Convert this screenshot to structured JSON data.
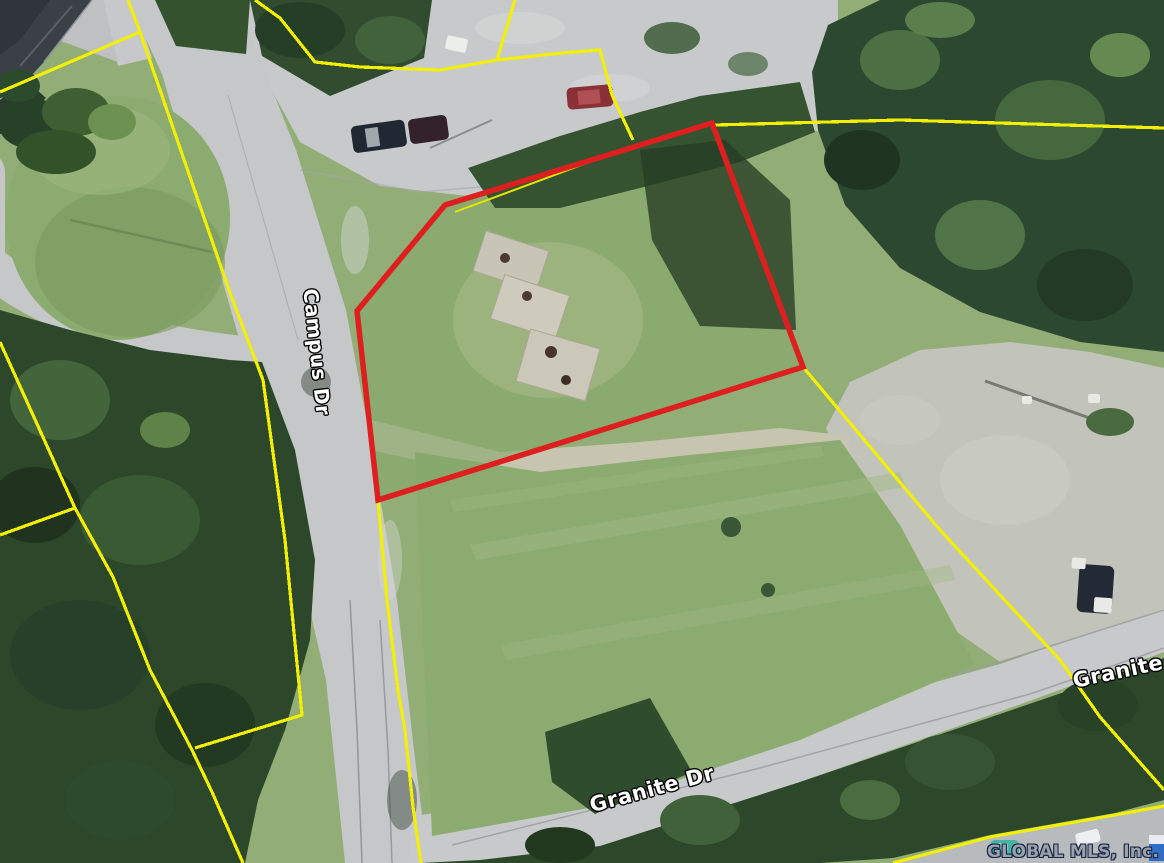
{
  "map": {
    "type": "satellite-aerial-parcel-view",
    "street_labels": [
      {
        "id": "campus-dr",
        "text": "Campus Dr"
      },
      {
        "id": "granite-dr",
        "text": "Granite Dr"
      },
      {
        "id": "granite-dr-right-edge",
        "text": "Granite D"
      }
    ],
    "watermark": "GLOBAL MLS, Inc.",
    "colors": {
      "highlighted_parcel_outline": "#de1f1f",
      "parcel_boundary_lines": "#f2ef04",
      "road": "#c7c9cb",
      "gravel": "#c2c3ba",
      "grass": "#93ad77",
      "forest": "#314c2f",
      "watermark_text": "#99a1ab"
    }
  }
}
